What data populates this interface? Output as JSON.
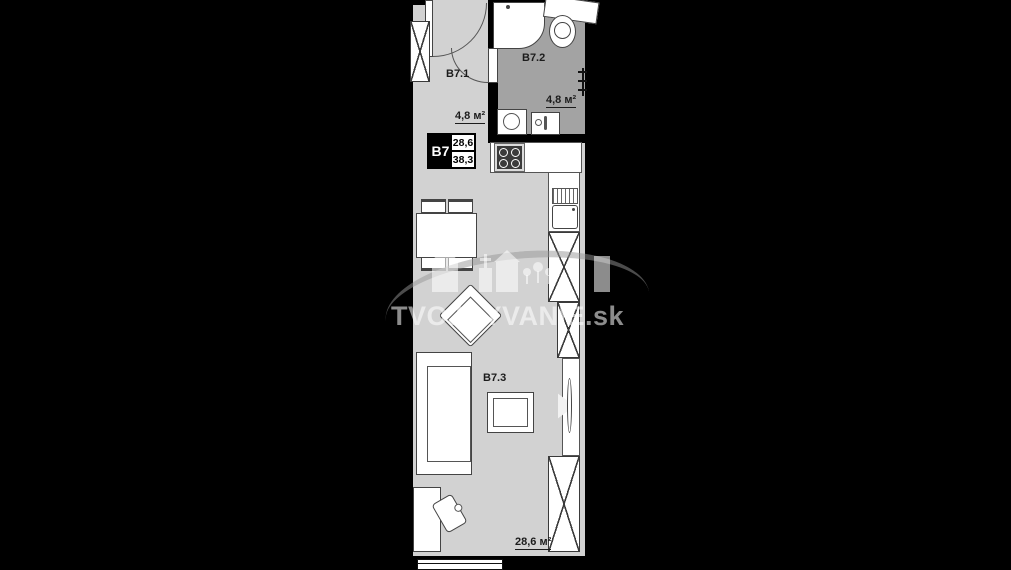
{
  "title": "Apartment B7 floor plan",
  "unit_box": {
    "code": "B7",
    "area_living": "28,6",
    "area_total": "38,3"
  },
  "rooms": {
    "hall": {
      "label": "B7.1",
      "area": "4,8 м²"
    },
    "bathroom": {
      "label": "B7.2",
      "area": "4,8 м²"
    },
    "living": {
      "label": "B7.3",
      "area": "28,6 м²"
    }
  },
  "watermark": {
    "text": "TVOJBYVANIE.sk"
  },
  "colors": {
    "background": "#000000",
    "floor": "#d2d2d2",
    "floor_bathroom": "#a3a3a3",
    "wall": "#000000",
    "fixture_fill": "#ffffff",
    "fixture_stroke": "#444444",
    "label_text": "#1c1c1c",
    "watermark": "#ffffff"
  }
}
